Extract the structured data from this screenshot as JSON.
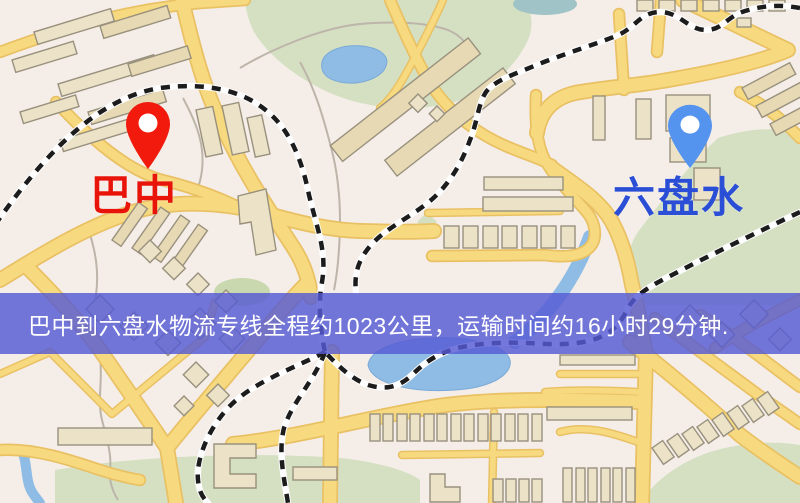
{
  "markers": {
    "origin": {
      "label": "巴中",
      "pin_color": "#f21a0d",
      "label_color": "#e8140a"
    },
    "destination": {
      "label": "六盘水",
      "pin_color": "#5493ee",
      "label_color": "#2b4ed6"
    }
  },
  "banner": {
    "text": "巴中到六盘水物流专线全程约1023公里，运输时间约16小时29分钟.",
    "background": "rgba(85,90,212,0.82)",
    "text_color": "#ffffff"
  },
  "map_palette": {
    "background": "#f5eee8",
    "road_fill": "#f7da7f",
    "road_edge": "#e9c164",
    "water": "#8fbce5",
    "park": "#d5e0c3",
    "building": "#ece2c8",
    "railway": "#1c1c1c",
    "minor_path": "#bdb5a9"
  }
}
